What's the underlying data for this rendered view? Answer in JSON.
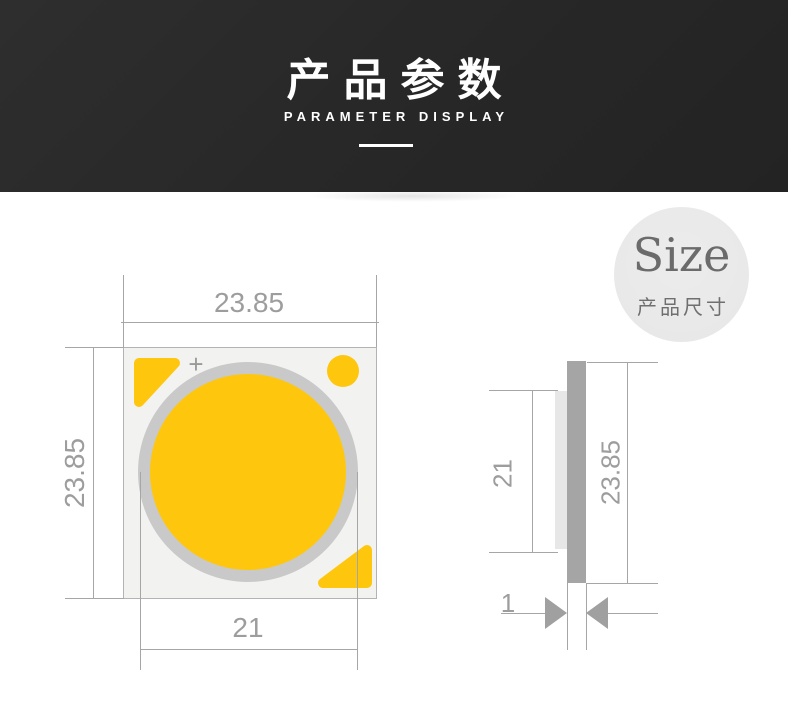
{
  "header": {
    "title": "产品参数",
    "subtitle": "PARAMETER DISPLAY",
    "bg_color": "#272727",
    "text_color": "#ffffff"
  },
  "size_badge": {
    "title": "Size",
    "subtitle": "产品尺寸",
    "bg_color": "#e9e9e9",
    "text_color": "#6b6b6b"
  },
  "drawing": {
    "colors": {
      "led_yellow": "#fec70d",
      "ring_gray": "#c9c9c9",
      "chip_fill": "#f2f2f1",
      "chip_border": "#b3b3b3",
      "dimension_line": "#a6a6a6",
      "dimension_text": "#9d9d9d",
      "substrate_gray": "#a5a5a5",
      "side_les_gray": "#e7e7e7"
    },
    "front_view": {
      "top_dim": "23.85",
      "left_dim": "23.85",
      "bottom_dim": "21",
      "polarity_mark": "+"
    },
    "side_view": {
      "les_dim": "21",
      "height_dim": "23.85",
      "thickness_dim": "1"
    }
  }
}
